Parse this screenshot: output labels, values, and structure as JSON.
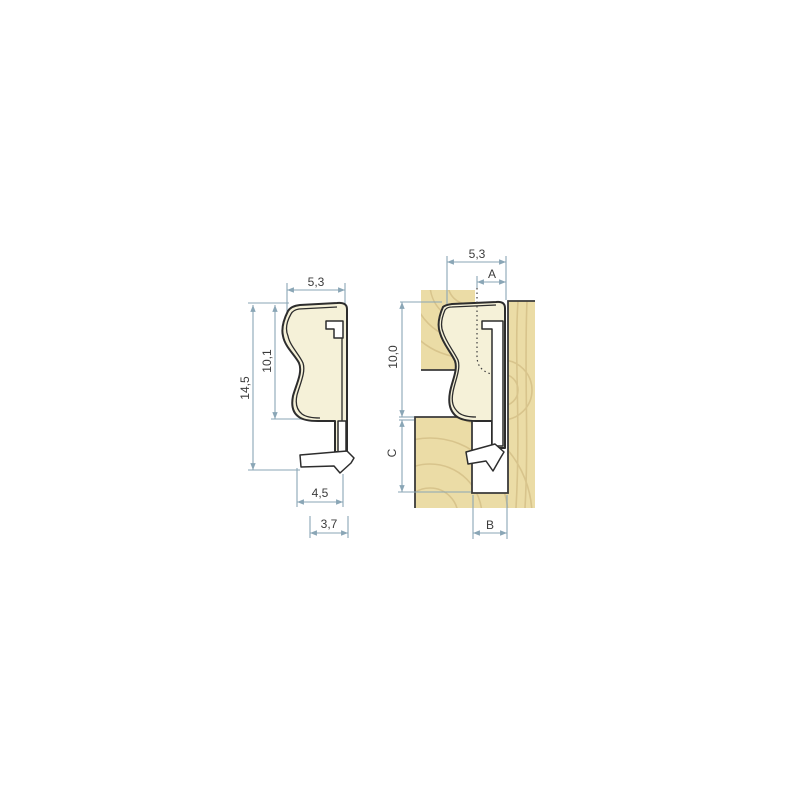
{
  "colors": {
    "background": "#ffffff",
    "seal_fill": "#f5f1d8",
    "seal_outline": "#2d2d2d",
    "wood_fill": "#ebdca6",
    "wood_grain": "#d8c48c",
    "wood_edge": "#3a3a3a",
    "dim_line": "#8aa6b6",
    "dim_text": "#3b3b3b"
  },
  "left_view": {
    "dims": {
      "top_width": "5,3",
      "bulb_height": "10,1",
      "total_height": "14,5",
      "foot_width": "4,5",
      "base_width": "3,7"
    }
  },
  "right_view": {
    "dims": {
      "top_width": "5,3",
      "compression": "A",
      "bulb_height": "10,0",
      "lower_depth": "C",
      "groove_width": "B"
    }
  }
}
